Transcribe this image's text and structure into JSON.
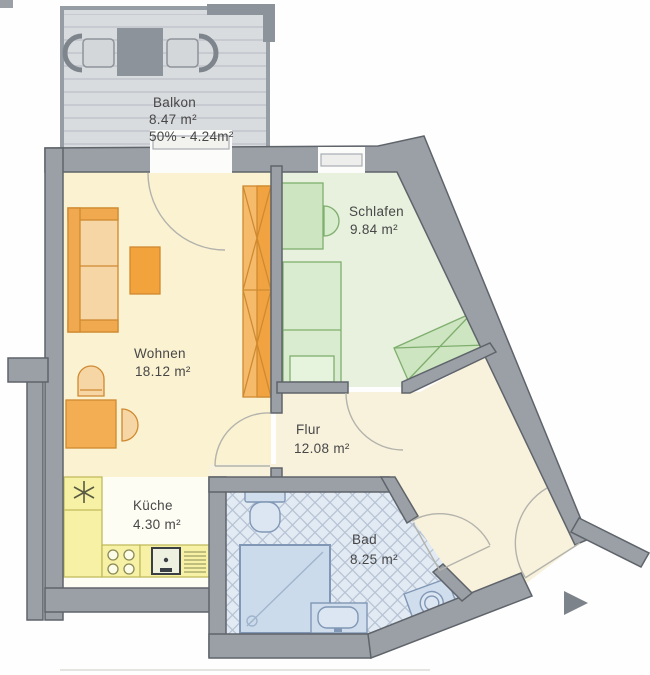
{
  "document": {
    "type": "apartment-floor-plan"
  },
  "rooms": {
    "balkon": {
      "label": "Balkon",
      "area": "8.47 m²",
      "share": "50% - 4.24m²"
    },
    "wohnen": {
      "label": "Wohnen",
      "area": "18.12 m²"
    },
    "schlafen": {
      "label": "Schlafen",
      "area": "9.84 m²"
    },
    "flur": {
      "label": "Flur",
      "area": "12.08 m²"
    },
    "kueche": {
      "label": "Küche",
      "area": "4.30 m²"
    },
    "bad": {
      "label": "Bad",
      "area": "8.25 m²"
    }
  },
  "colors": {
    "wall": "#9aa0a6",
    "wall_outline": "#5f646b",
    "wohnen_floor": "#fbf2d2",
    "flur_floor": "#f8f2dc",
    "schlafen_floor": "#e7f1de",
    "bad_floor": "#e2eaf3",
    "kueche_floor": "#fdfdf4",
    "balcony_deck": "#d9dcdf",
    "counter_yellow": "#f6f1a5",
    "furniture_orange": "#f0a94e",
    "furniture_green": "#cde5c0",
    "fixture_blue": "#cfdded",
    "arrow": "#7d838a"
  }
}
